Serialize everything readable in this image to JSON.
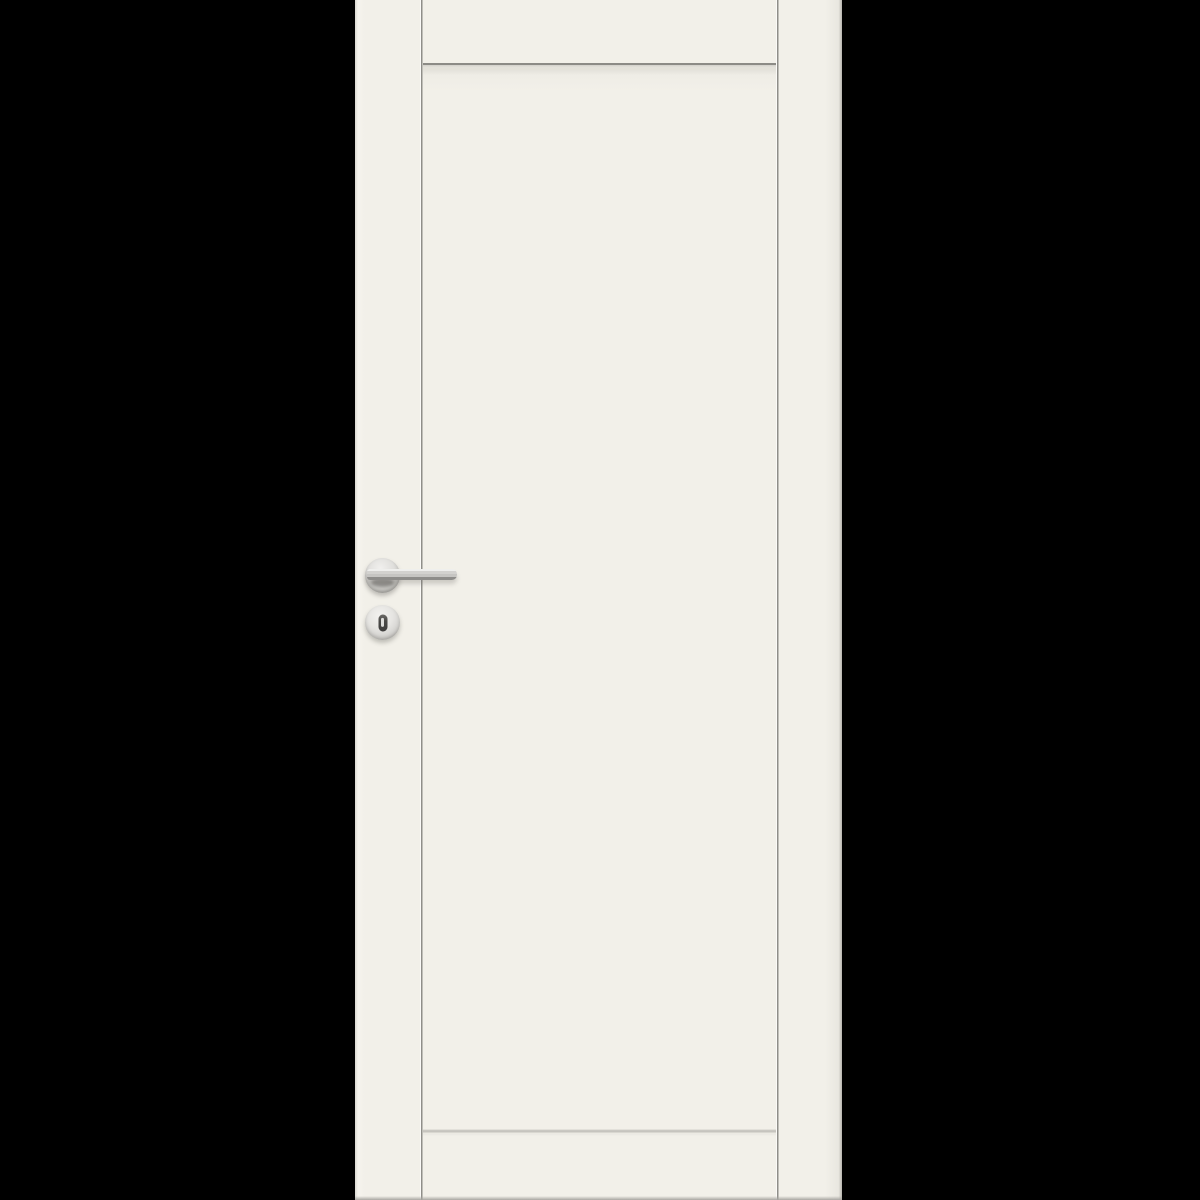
{
  "scene": {
    "description": "Product photograph of a white interior door with one large recessed flat panel, shown front-on against a solid black background. The door fills the full image height.",
    "image_type": "product-photo",
    "visible_text": "",
    "door": {
      "style": "single recessed panel (one vertical groove near each stile, horizontal groove under top rail and above bottom rail)",
      "finish": "matte off-white painted wood",
      "hardware": [
        "satin-chrome lever handle on round rosette, pointing right",
        "round satin-chrome keyhole escutcheon with dark oval key cylinder below the handle"
      ]
    }
  },
  "parts": {
    "door_leaf": "door-leaf",
    "stile_groove_left": "stile-groove-left",
    "stile_groove_right": "stile-groove-right",
    "top_rail_groove": "top-rail-groove",
    "bottom_rail_groove": "bottom-rail-groove",
    "panel": "door-panel",
    "handle": "lever-handle",
    "rosette": "handle-rosette",
    "escutcheon": "keyhole-escutcheon",
    "keyhole": "keyhole"
  },
  "colors": {
    "bg": "#000000",
    "door-face": "#f2f0e9",
    "door-face-soft": "#efede6",
    "door-edge-left": "#dbd9d2",
    "door-edge-right": "#b7b5af",
    "door-edge-bottom": "#a8a6a1",
    "groove-dark": "#8f8e89",
    "groove-light": "#fbfaf7",
    "groove-soft": "#c6c4be",
    "groove-soft-light": "#eceae3",
    "metal-light": "#efefed",
    "metal-mid": "#c6c5c2",
    "metal-dark": "#8e8d8a",
    "keyhole-dark": "#4a4947",
    "keyslot-light": "#dededc"
  }
}
